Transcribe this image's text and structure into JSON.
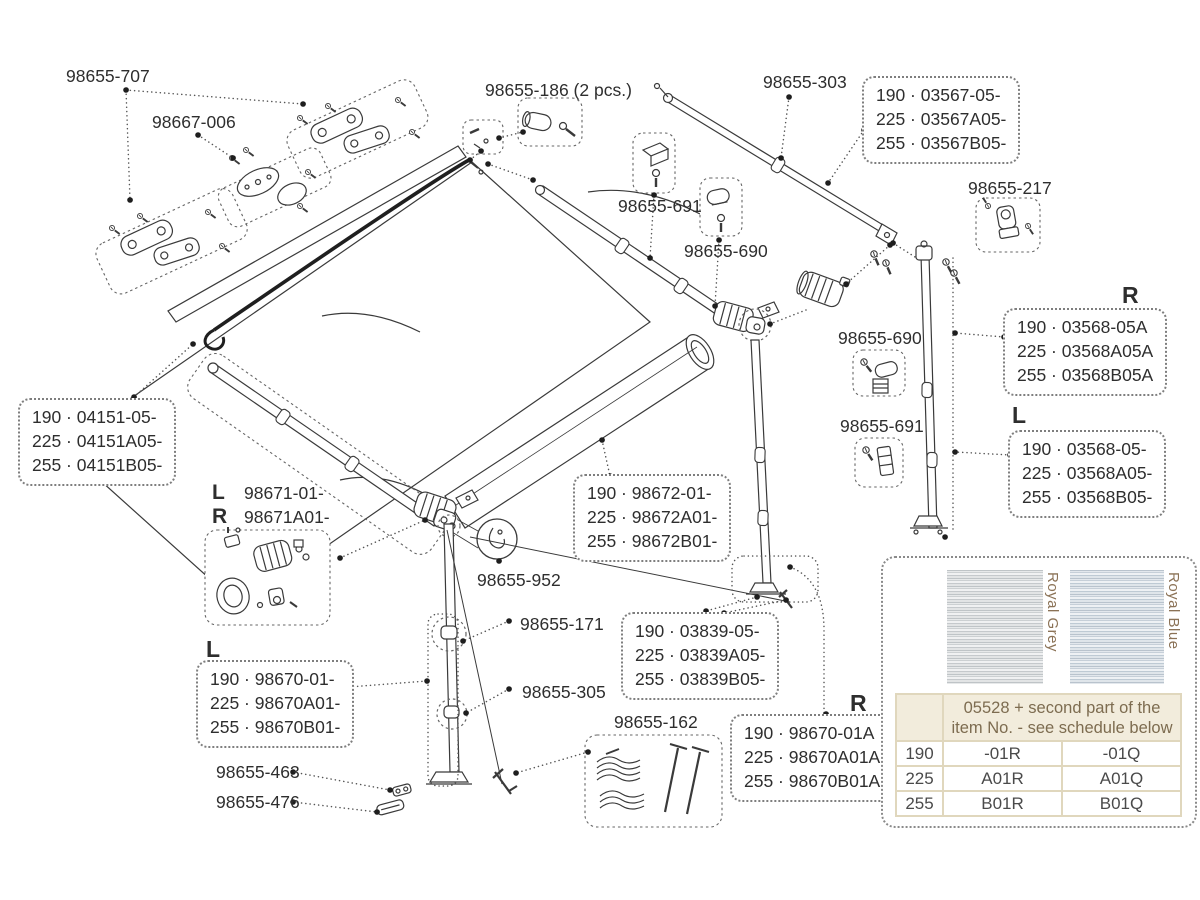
{
  "parts": {
    "p707": "98655-707",
    "p006": "98667-006",
    "p186": "98655-186 (2 pcs.)",
    "p303": "98655-303",
    "p691a": "98655-691",
    "p690a": "98655-690",
    "p217": "98655-217",
    "p690b": "98655-690",
    "p691b": "98655-691",
    "p952": "98655-952",
    "p171": "98655-171",
    "p305": "98655-305",
    "p463": "98655-463",
    "p476": "98655-476",
    "p162": "98655-162"
  },
  "lr": {
    "L": "L",
    "R": "R"
  },
  "arm_assembly": {
    "left_letter": "L",
    "left_code": "98671-01-",
    "right_letter": "R",
    "right_code": "98671A01-"
  },
  "part_boxes": {
    "b03567": [
      "190 · 03567-05-",
      "225 · 03567A05-",
      "255 · 03567B05-"
    ],
    "b03568R": [
      "190 · 03568-05A",
      "225 · 03568A05A",
      "255 · 03568B05A"
    ],
    "b03568L": [
      "190 · 03568-05-",
      "225 · 03568A05-",
      "255 · 03568B05-"
    ],
    "b04151": [
      "190 · 04151-05-",
      "225 · 04151A05-",
      "255 · 04151B05-"
    ],
    "b98672": [
      "190 · 98672-01-",
      "225 · 98672A01-",
      "255 · 98672B01-"
    ],
    "b03839": [
      "190 · 03839-05-",
      "225 · 03839A05-",
      "255 · 03839B05-"
    ],
    "b98670L": [
      "190 · 98670-01-",
      "225 · 98670A01-",
      "255 · 98670B01-"
    ],
    "b98670R": [
      "190 · 98670-01A",
      "225 · 98670A01A",
      "255 · 98670B01A"
    ]
  },
  "fabric_table": {
    "header_line1": "05528 + second part of the",
    "header_line2": "item No. - see schedule below",
    "swatches": [
      {
        "label": "Royal Grey"
      },
      {
        "label": "Royal Blue"
      }
    ],
    "rows": [
      {
        "size": "190",
        "grey": "-01R",
        "blue": "-01Q"
      },
      {
        "size": "225",
        "grey": "A01R",
        "blue": "A01Q"
      },
      {
        "size": "255",
        "grey": "B01R",
        "blue": "B01Q"
      }
    ],
    "colors": {
      "header_bg": "#f2ecdc",
      "border": "#e0d7bd",
      "label_text": "#8b7256",
      "value_text": "#4a4a4a",
      "swatch_grey": "#c3c7c9",
      "swatch_blue": "#bfc9d4"
    }
  },
  "colors": {
    "linework": "#3a3a3a",
    "label_text": "#2e2e2e",
    "background": "#ffffff"
  }
}
